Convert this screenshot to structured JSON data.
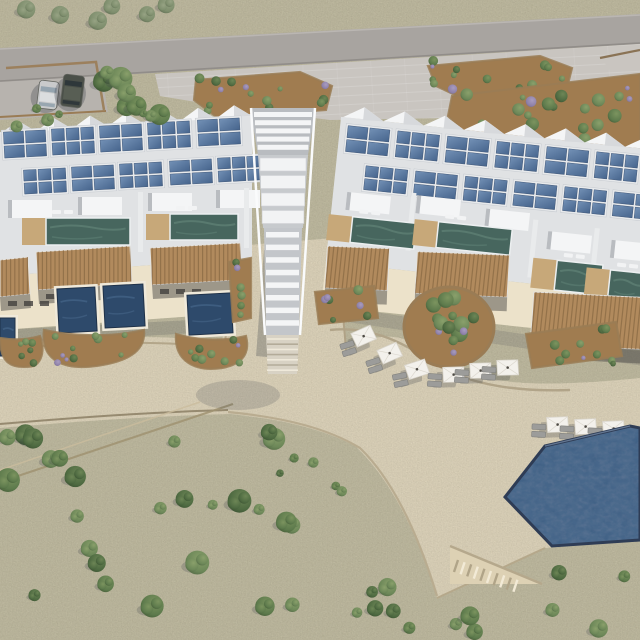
{
  "scene": {
    "type": "aerial-3d-architectural-render",
    "subject": "hillside seaside resort masterplan: two terraced villa blocks with rooftop solar panels, private lap and plunge pools, a central stair tower, sun-lounger terraces and a large communal pool",
    "setting": "dry scrubland with scattered shrubs, access road and parking at top",
    "lighting": "midday sun from upper right, shadows cast down-left"
  },
  "inventory": {
    "villa_blocks": 2,
    "stair_tower": 1,
    "solar_arrays": 22,
    "rooftop_lap_pools": 6,
    "plunge_pools": 4,
    "communal_pool": 1,
    "umbrella_lounger_sets": 9,
    "parked_cars": 2,
    "raised_planters": 4,
    "garden_beds": 8,
    "access_road": 1
  },
  "vegetation": {
    "seed": 7,
    "scatter_bush_count": 73
  },
  "palette": {
    "scrub": "#c6c0a3",
    "road": "#a8a4a0",
    "road_edge_light": "#bab6b2",
    "road_edge_dark": "#918d89",
    "paving": "#c9c5c0",
    "parking": "#b7b3ae",
    "sand": "#e7dcc0",
    "sand_bright": "#ece2ca",
    "sand_wall": "#a2947a",
    "wall_dark": "#7c7057",
    "stone": "#9a7c55",
    "soil": "#a07c50",
    "soil_dark": "#8a6a46",
    "slab": "#e0e2e4",
    "roof_white": "#eceded",
    "roof_bright": "#f4f5f6",
    "roof_mid": "#d7d9dc",
    "roof_shadow": "#b9bcc0",
    "solar": "#51739e",
    "solar_dark": "#46648c",
    "solar_light": "#7391b6",
    "teal_pool": "#47665e",
    "teal_light": "#6e9284",
    "navy_pool": "#2e4a6b",
    "navy_light": "#4a6a8e",
    "main_pool": "#4e6588",
    "pool_rim": "#2e3c55",
    "wood": "#b18a5d",
    "wood_dark": "#8a6a44",
    "deck_wood": "#c7a879",
    "pergola_shade": "#4e4b47",
    "bush_a": "#4e6a41",
    "bush_b": "#5d7a4c",
    "bush_c": "#6c8758",
    "bush_olive": "#7e8e6d",
    "lavender": "#8d80a8",
    "umbrella": "#f3f1ec",
    "lounger": "#9c9c9a",
    "car_silver": "#c9cacb",
    "car_dark": "#4b5049",
    "shadow": "#3a3f49"
  }
}
